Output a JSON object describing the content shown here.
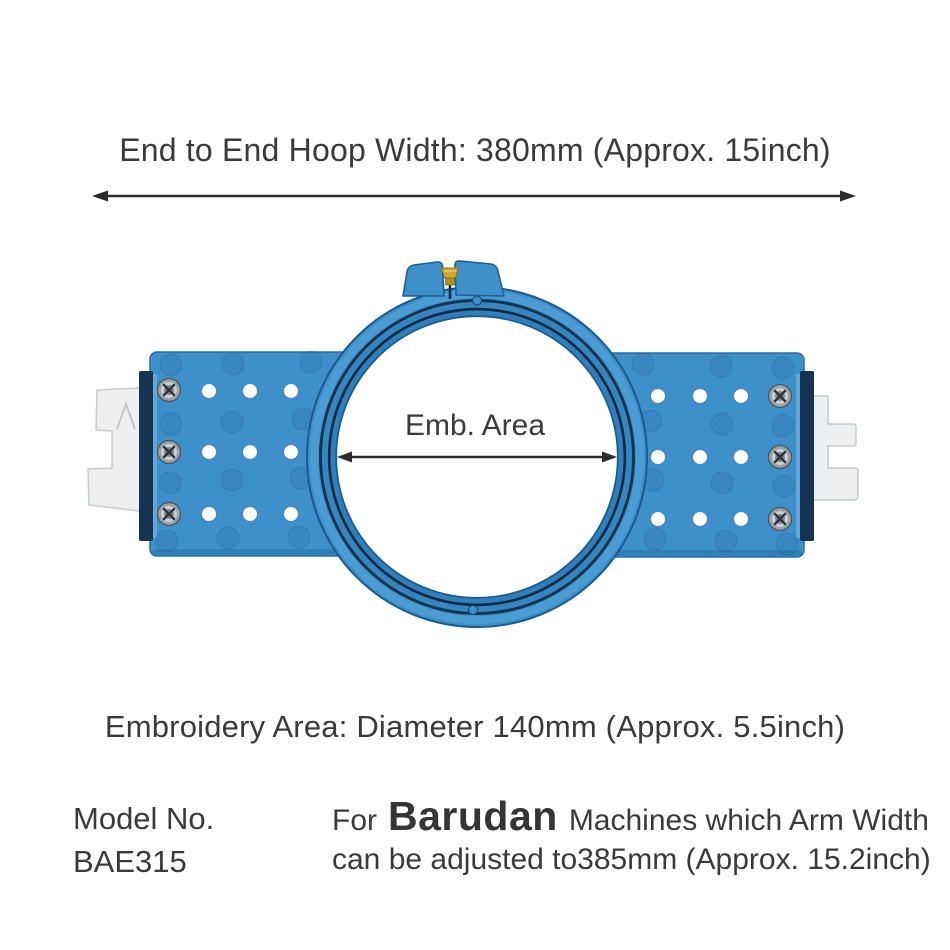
{
  "page": {
    "background": "#FFFFFF"
  },
  "annotations": {
    "hoop_width_label": "End to End Hoop Width: 380mm (Approx. 15inch)",
    "emb_area_label": "Emb. Area",
    "embroidery_area_label": "Embroidery Area: Diameter 140mm (Approx. 5.5inch)"
  },
  "model": {
    "label": "Model No.",
    "value": "BAE315"
  },
  "machine_note": {
    "prefix": "For",
    "brand": "Barudan",
    "line1_rest": "Machines which Arm Width",
    "line2": "can be adjusted to385mm (Approx. 15.2inch)"
  },
  "product": {
    "type": "round tubular embroidery hoop with mounting arms",
    "colors": {
      "hoop_blue": "#3E90CB",
      "hoop_blue_dark": "#2F80BA",
      "groove_dark": "#0F2C44",
      "edge_outline": "#1D5F95",
      "side_sash": "#16334F",
      "bracket_white": "#EDEFF0",
      "screw_silver": "#C9CFD4",
      "brass_screw": "#CDA72F",
      "annotation_text": "#3A3A3A",
      "arrow": "#2B2B2B"
    },
    "icons": {
      "phillips-screw-icon": "silver cross-head screw",
      "brass-thumb-screw-icon": "gold tightening screw at hoop clamp",
      "alignment-hole": "white through-hole in arm plate",
      "embossed-dimple": "molded circular dimple in arm plate"
    }
  }
}
